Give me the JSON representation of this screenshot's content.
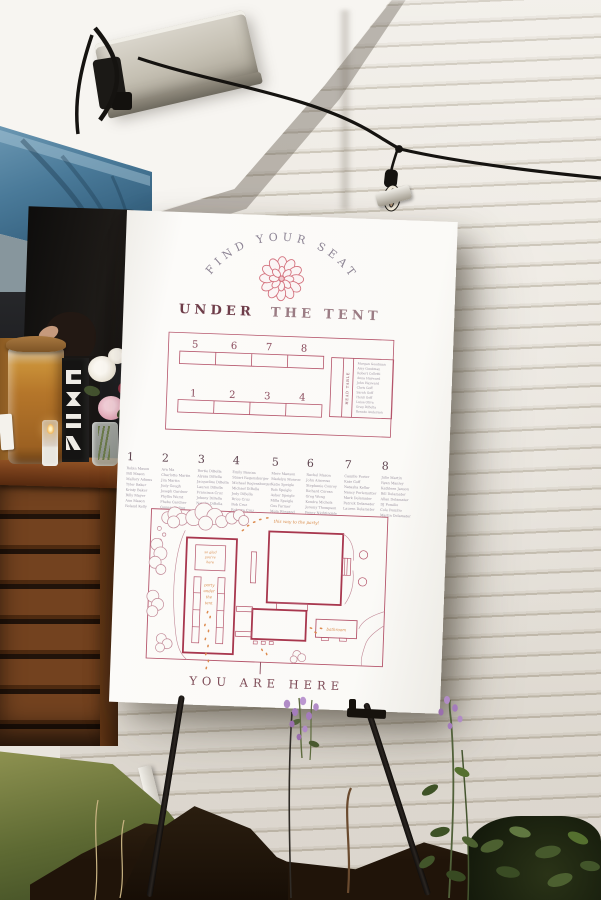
{
  "sign": {
    "arc_title": "FIND YOUR SEAT",
    "subtitle": {
      "word1": "UNDER",
      "rest": "THE TENT"
    },
    "tables": {
      "top_row": [
        "5",
        "6",
        "7",
        "8"
      ],
      "bottom_row": [
        "1",
        "2",
        "3",
        "4"
      ]
    },
    "head_table": {
      "label": "HEAD TABLE",
      "names": [
        "Morgan Goodman",
        "Amy Goodman",
        "Robert Colletti",
        "Anna Hayward",
        "John Hayward",
        "Chris Goff",
        "Sarah Goff",
        "Heidi Goff",
        "Luisa Oliva",
        "Greg DiBella",
        "Renato Anderson"
      ]
    },
    "seating_columns": [
      {
        "number": "1",
        "names": [
          "Robin Mason",
          "Bill Mason",
          "Mallory Adams",
          "Tyler Baker",
          "Kristy Baker",
          "Billy Mayer",
          "Ann Mason",
          "Roland Kelly"
        ]
      },
      {
        "number": "2",
        "names": [
          "Ava Ma",
          "Charlotte Martin",
          "Jim Martin",
          "Judy Gough",
          "Joseph Gardner",
          "Phyllis Wurst",
          "Phebe Gardner",
          "Gunnar Kaling"
        ]
      },
      {
        "number": "3",
        "names": [
          "Bertie DiBella",
          "Alyssa DiBella",
          "Jacqueline DiBella",
          "Lauren DiBella",
          "Francisca Cruz",
          "Johnny DiBella",
          "Natalia DiBella",
          "Bill Seymour"
        ]
      },
      {
        "number": "4",
        "names": [
          "Emily Bancas",
          "Stuart Regensburger",
          "Michael Regensburger",
          "Michael DiBella",
          "Jody DiBella",
          "Brice Cruz",
          "Bob Cruz",
          "Roberta Cruz"
        ]
      },
      {
        "number": "5",
        "names": [
          "Mere Manson",
          "Madelyn Monroe",
          "Katie Speigle",
          "Rob Speigle",
          "Asher Speigle",
          "Milla Speigle",
          "Gus Farmer",
          "Mela Wiegand"
        ]
      },
      {
        "number": "6",
        "names": [
          "Rachel Mason",
          "John Amoroso",
          "Stephanie Conroy",
          "Richard Curran",
          "Greg Wong",
          "Kendra Michels",
          "Jeremy Thompson",
          "Penny Nightingale"
        ]
      },
      {
        "number": "7",
        "names": [
          "Camille Porter",
          "Kate Goff",
          "Natasha Kellar",
          "Nancy Perlemutter",
          "Mark Delamater",
          "Patrick Delamater",
          "Lauren Delamater"
        ]
      },
      {
        "number": "8",
        "names": [
          "Julie Martin",
          "Ryan Manley",
          "Kathleen Janson",
          "Bill Delamater",
          "Allan Delamater",
          "DJ Pomilio",
          "Cole Pomilio",
          "Martin Delamater"
        ]
      }
    ],
    "map": {
      "path_label": "this way to the party!",
      "tent_head_label": [
        "so glad",
        "you're",
        "here"
      ],
      "tent_aisle_label": [
        "party",
        "under",
        "the",
        "tent"
      ],
      "bathroom_label": "bathroom"
    },
    "footer": "YOU ARE HERE"
  },
  "colors": {
    "sign_line": "#b5556b",
    "sign_bold_line": "#a8374e",
    "script_orange": "#d98a4a",
    "names_gray": "#9b93a0",
    "heading_plum": "#7d4a56",
    "arc_gray": "#8d8494",
    "rosette_pink": "#d4737f",
    "tarp_blue": "#4a7a99",
    "siding_cream": "#e9e5de",
    "drink_amber": "#b5762a"
  }
}
